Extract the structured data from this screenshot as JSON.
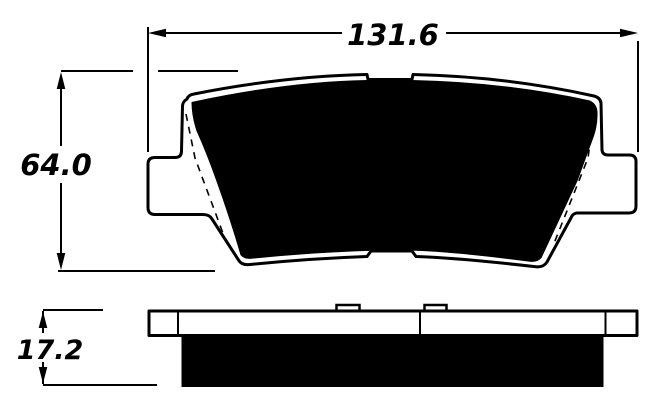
{
  "drawing": {
    "dim_width": "131.6",
    "dim_height": "64.0",
    "dim_thickness": "17.2"
  },
  "colors": {
    "ink": "#000000",
    "paper": "#ffffff"
  }
}
